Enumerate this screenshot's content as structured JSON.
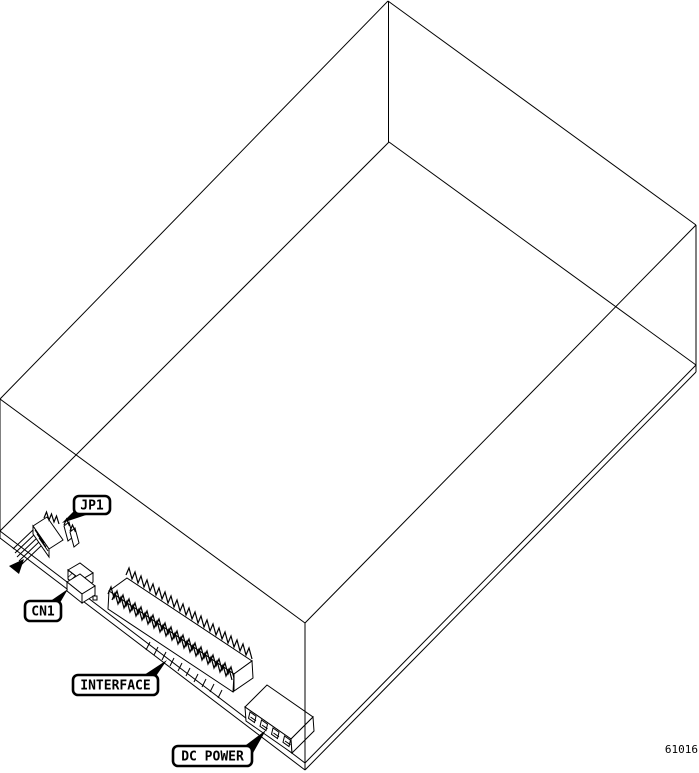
{
  "figure_number": "61016",
  "labels": {
    "jp1": "JP1",
    "cn1": "CN1",
    "interface": "INTERFACE",
    "dc_power": "DC POWER"
  },
  "colors": {
    "line": "#000000",
    "background": "#ffffff"
  }
}
